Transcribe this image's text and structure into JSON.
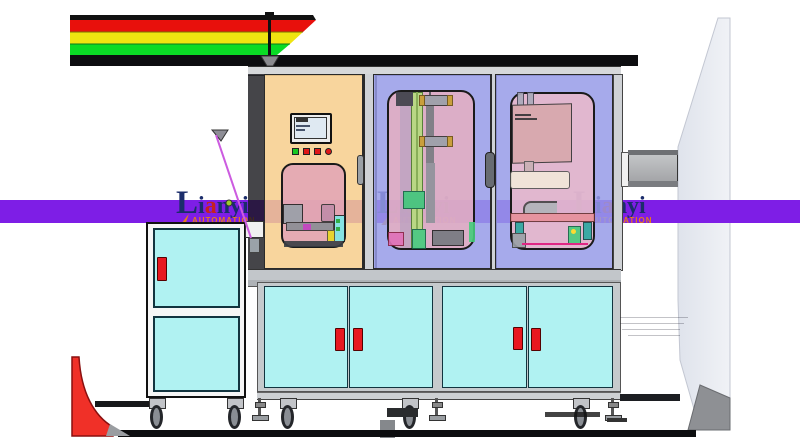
{
  "watermark": {
    "brand_cap": "L",
    "brand_p1": "i",
    "brand_accent": "a",
    "brand_p2": "nyi",
    "subtitle": "AUTOMATION",
    "instances": [
      "left",
      "center",
      "right"
    ]
  },
  "palette": {
    "band": "#7e1ee6",
    "navy": "#1b2d6b",
    "accent": "#c42222",
    "orange": "#e5791e",
    "cyan": "#b0f2f2",
    "redh": "#e81820",
    "stripe_red": "#e8100c",
    "stripe_yellow": "#efe410",
    "stripe_green": "#0adb25",
    "door_peach": "#f7d7a5",
    "door_lavender": "#a9aeea",
    "window_pink": "#eabfc6",
    "side_panel_gray": "#e4e7ee"
  },
  "signal_bar": {
    "colors_top_to_bottom": [
      "red",
      "yellow",
      "green"
    ]
  },
  "hmi": {
    "buttons": [
      "green-square",
      "red-square",
      "red-square",
      "red-round"
    ]
  },
  "cabinet": {
    "upper_doors": [
      "peach-control-door",
      "lavender-process-door",
      "lavender-unload-door"
    ],
    "lower_doors": 4,
    "handle_color": "red"
  },
  "cart": {
    "panels": 2,
    "handle_color": "red"
  }
}
